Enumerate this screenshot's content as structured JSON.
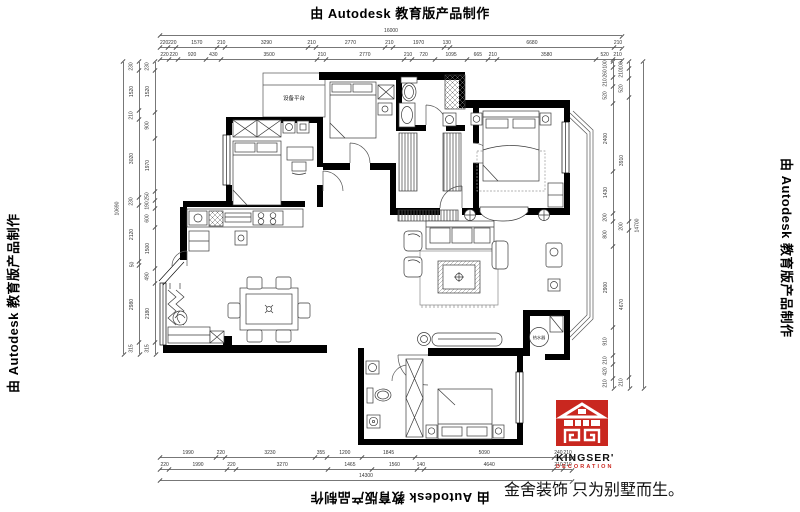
{
  "watermark": {
    "text": "由 Autodesk 教育版产品制作"
  },
  "branding": {
    "logo_line1": "KINGSER'",
    "logo_line2": "DECORATION",
    "logo_color": "#c9271f",
    "slogan": "金舍装饰 只为别墅而生。"
  },
  "plan_labels": {
    "platform": "设备平台",
    "water_heater": "热水器"
  },
  "dimensions": {
    "top_overall": [
      "16000"
    ],
    "top_row1": [
      "220",
      "220",
      "1570",
      "210",
      "3290",
      "210",
      "2770",
      "210",
      "1970",
      "130",
      "6680",
      "210"
    ],
    "top_row2": [
      "220",
      "220",
      "920",
      "430",
      "3500",
      "210",
      "2770",
      "210",
      "720",
      "1095",
      "665",
      "210",
      "3580",
      "520",
      "210"
    ],
    "left_overall": [
      "10690"
    ],
    "left_col_outer": [
      "230",
      "1520",
      "210",
      "3020",
      "230",
      "2120",
      "50",
      "2980",
      "315"
    ],
    "left_col_inner": [
      "230",
      "1520",
      "900",
      "1970",
      "250",
      "190",
      "600",
      "1500",
      "490",
      "2180",
      "315"
    ],
    "right_col_inner": [
      "100",
      "260",
      "210",
      "520",
      "2400",
      "1430",
      "200",
      "800",
      "2900",
      "910",
      "210",
      "420",
      "210"
    ],
    "right_col_outer": [
      "100",
      "210",
      "520",
      "3910",
      "200",
      "4670",
      "210"
    ],
    "right_overall": [
      "14700"
    ],
    "bottom_row1": [
      "1990",
      "220",
      "3230",
      "355",
      "1200",
      "1845",
      "5090",
      "240",
      "210"
    ],
    "bottom_row2": [
      "220",
      "1990",
      "220",
      "3270",
      "1465",
      "1560",
      "140",
      "4640",
      "210",
      "210"
    ],
    "bottom_overall": [
      "14300"
    ]
  }
}
